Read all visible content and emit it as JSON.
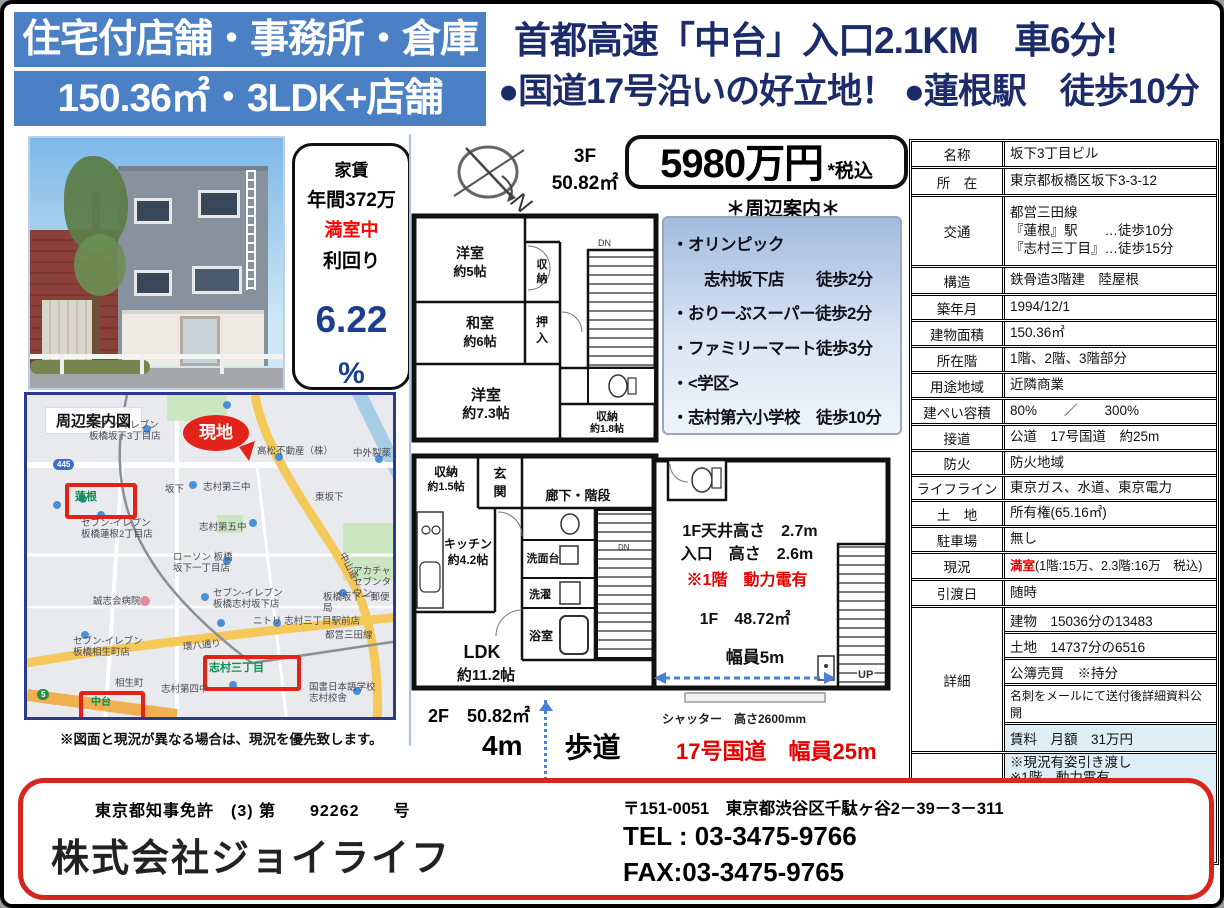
{
  "header": {
    "banner_line1": "住宅付店舗・事務所・倉庫",
    "banner_line2": "150.36㎡・3LDK+店舗",
    "headline_line1": "首都高速「中台」入口2.1KM　車6分!",
    "headline_line2": "●国道17号沿いの好立地！ ●蓮根駅　徒歩10分"
  },
  "rent_box": {
    "title": "家賃",
    "annual": "年間372万",
    "occupancy": "満室中",
    "yield_label": "利回り",
    "yield_value": "6.22",
    "yield_unit": "%"
  },
  "price": {
    "amount": "5980万円",
    "tax": "*税込"
  },
  "nearby": {
    "title": "＊周辺案内＊",
    "items": [
      "・オリンピック",
      "　　志村坂下店　　徒歩2分",
      "・おりーぶスーパー徒歩2分",
      "・ファミリーマート徒歩3分",
      "・<学区>",
      "・志村第六小学校　徒歩10分"
    ]
  },
  "plans": {
    "compass_n": "N",
    "f3": {
      "floor": "3F",
      "area": "50.82㎡",
      "dn": "DN",
      "room1": "洋室",
      "room1_size": "約5帖",
      "closet1a": "収",
      "closet1b": "納",
      "room2": "和室",
      "room2_size": "約6帖",
      "oshiire_a": "押",
      "oshiire_b": "入",
      "room3": "洋室",
      "room3_size": "約7.3帖",
      "closet2": "収納",
      "closet2_size": "約1.8帖"
    },
    "f2": {
      "label": "2F　50.82㎡",
      "dn": "DN",
      "closet": "収納",
      "closet_size": "約1.5帖",
      "genkan_a": "玄",
      "genkan_b": "関",
      "hall": "廊下・階段",
      "kitchen": "キッチン",
      "kitchen_size": "約4.2帖",
      "senmendai": "洗面台",
      "sentaku": "洗濯",
      "bath": "浴室",
      "ldk": "LDK",
      "ldk_size": "約11.2帖"
    },
    "f1": {
      "ceiling": "1F天井高さ　2.7m",
      "entrance": "入口　高さ　2.6m",
      "power": "※1階　動力電有",
      "area": "1F　48.72㎡",
      "width": "幅員5m",
      "up": "UP",
      "shutter": "シャッター　高さ2600mm"
    },
    "sidewalk_left": "4m",
    "sidewalk_right": "歩道",
    "road_note": "17号国道　幅員25m"
  },
  "map": {
    "title": "周辺案内図",
    "site_marker": "現地",
    "shields": [
      "445",
      "5"
    ],
    "labels": [
      "セブン-イレブン\n板橋坂下3丁目店",
      "高松不動産（株）",
      "中外製薬",
      "蓮根",
      "坂下",
      "志村第三中",
      "東坂下",
      "セブン-イレブン\n板橋蓮根2丁目店",
      "志村第五中",
      "ローソン 板橋\n坂下一丁目店",
      "誠志会病院",
      "セブン-イレブン\n板橋志村坂下店",
      "ニトリ 志村三丁目駅前店",
      "板橋坂下一郵便局",
      "セブン-イレブン\n板橋相生町店",
      "相生町",
      "志村第四中",
      "志村三丁目",
      "国書日本語学校\n志村校舎",
      "中台",
      "中山道",
      "都営三田線",
      "環八通り",
      "アカチャ\nセブンタウン"
    ],
    "disclaimer": "※図面と現況が異なる場合は、現況を優先致します。"
  },
  "table": {
    "name_label": "名称",
    "name": "坂下3丁目ビル",
    "location_label": "所　在",
    "location": "東京都板橋区坂下3-3-12",
    "access_label": "交通",
    "access": "都営三田線\n『蓮根』駅　　…徒歩10分\n『志村三丁目』…徒歩15分",
    "structure_label": "構造",
    "structure": "鉄骨造3階建　陸屋根",
    "built_label": "築年月",
    "built": "1994/12/1",
    "bldg_area_label": "建物面積",
    "bldg_area": "150.36㎡",
    "floors_label": "所在階",
    "floors": "1階、2階、3階部分",
    "zoning_label": "用途地域",
    "zoning": "近隣商業",
    "coverage_label": "建ぺい容積",
    "coverage": "80%　　／　　300%",
    "road_label": "接道",
    "road": "公道　17号国道　約25m",
    "fire_label": "防火",
    "fire": "防火地域",
    "lifeline_label": "ライフライン",
    "lifeline": "東京ガス、水道、東京電力",
    "land_label": "土　地",
    "land": "所有権(65.16㎡)",
    "parking_label": "駐車場",
    "parking": "無し",
    "status_label": "現況",
    "status_red": "満室",
    "status_rest": "(1階:15万、2.3階:16万　税込)",
    "handover_label": "引渡日",
    "handover": "随時",
    "detail_label": "詳細",
    "detail_items": [
      "建物　15036分の13483",
      "土地　14737分の6516",
      "公簿売買　※持分",
      "名刺をメールにて送付後詳細資料公開",
      "賃料　月額　31万円"
    ],
    "remarks_label": "備考",
    "remarks": "※現況有姿引き渡し\n※1階　動力電有\n※2021年室内リフォーム\n※2024年1月　外壁塗装・屋上防水\n※2024年2月エアコン2台交換\n※2024年7月　共用部塗装"
  },
  "footer": {
    "license": "東京都知事免許　(3) 第　　92262　　号",
    "company": "株式会社ジョイライフ",
    "address": "〒151-0051　東京都渋谷区千駄ヶ谷2－39－3－311",
    "tel": "TEL : 03-3475-9766",
    "fax": "FAX:03-3475-9765"
  }
}
